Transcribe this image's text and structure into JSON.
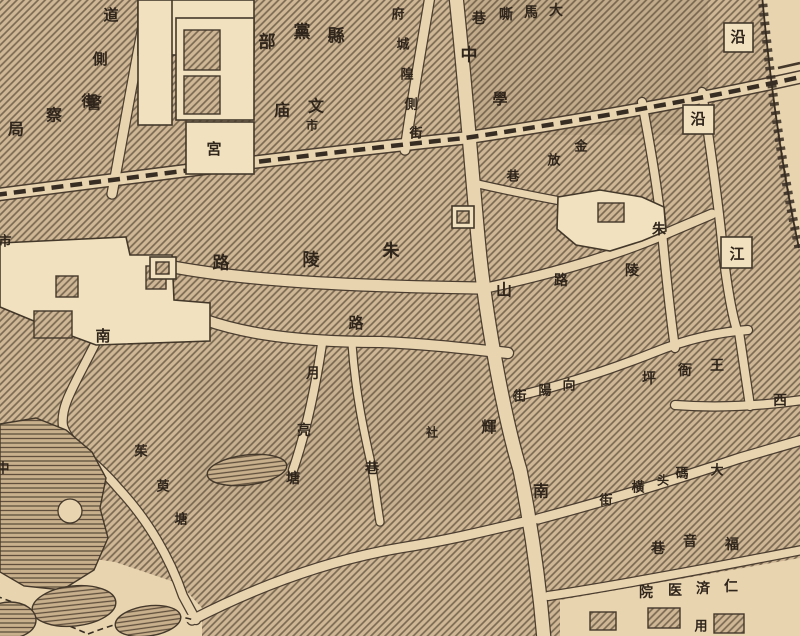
{
  "map": {
    "kind": "historical Chinese city street map (woodcut style)",
    "colors": {
      "paper": "#e9d4b0",
      "building_fill": "#f1e1be",
      "block_base": "#cfb795",
      "ink": "#43382a",
      "label_ink": "#2f251b"
    }
  },
  "labels": [
    {
      "name": "jingchaju",
      "text": "警察局",
      "chars": [
        {
          "c": "局",
          "x": 16,
          "y": 130,
          "s": 16
        },
        {
          "c": "察",
          "x": 54,
          "y": 116,
          "s": 16
        },
        {
          "c": "警",
          "x": 94,
          "y": 104,
          "s": 16
        }
      ]
    },
    {
      "name": "daoce-street",
      "text": "道側街",
      "chars": [
        {
          "c": "道",
          "x": 111,
          "y": 16,
          "s": 15
        },
        {
          "c": "側",
          "x": 100,
          "y": 60,
          "s": 15
        },
        {
          "c": "街",
          "x": 89,
          "y": 102,
          "s": 15
        }
      ]
    },
    {
      "name": "xiandangbu",
      "text": "縣黨部",
      "chars": [
        {
          "c": "部",
          "x": 267,
          "y": 43,
          "s": 17
        },
        {
          "c": "黨",
          "x": 302,
          "y": 33,
          "s": 17
        },
        {
          "c": "縣",
          "x": 336,
          "y": 37,
          "s": 17
        }
      ]
    },
    {
      "name": "wenmiao",
      "text": "文庙",
      "chars": [
        {
          "c": "庙",
          "x": 282,
          "y": 111,
          "s": 16
        },
        {
          "c": "文",
          "x": 316,
          "y": 107,
          "s": 16
        }
      ]
    },
    {
      "name": "shi-small",
      "text": "市",
      "chars": [
        {
          "c": "市",
          "x": 312,
          "y": 126,
          "s": 12
        }
      ]
    },
    {
      "name": "fuchenghuang-street",
      "text": "府城隍側街",
      "chars": [
        {
          "c": "府",
          "x": 398,
          "y": 15,
          "s": 13
        },
        {
          "c": "城",
          "x": 403,
          "y": 45,
          "s": 13
        },
        {
          "c": "隍",
          "x": 407,
          "y": 75,
          "s": 13
        },
        {
          "c": "側",
          "x": 411,
          "y": 105,
          "s": 13
        },
        {
          "c": "街",
          "x": 416,
          "y": 134,
          "s": 13
        }
      ]
    },
    {
      "name": "gong",
      "text": "宮",
      "chars": [
        {
          "c": "宮",
          "x": 214,
          "y": 150,
          "s": 15
        }
      ]
    },
    {
      "name": "damasi-lane",
      "text": "大馬嘶巷",
      "chars": [
        {
          "c": "巷",
          "x": 479,
          "y": 19,
          "s": 14
        },
        {
          "c": "嘶",
          "x": 506,
          "y": 15,
          "s": 14
        },
        {
          "c": "馬",
          "x": 531,
          "y": 13,
          "s": 14
        },
        {
          "c": "大",
          "x": 556,
          "y": 11,
          "s": 14
        }
      ]
    },
    {
      "name": "char-zhong",
      "text": "中",
      "chars": [
        {
          "c": "中",
          "x": 469,
          "y": 56,
          "s": 17
        }
      ]
    },
    {
      "name": "char-xue",
      "text": "學",
      "chars": [
        {
          "c": "學",
          "x": 500,
          "y": 100,
          "s": 15
        }
      ]
    },
    {
      "name": "char-shan",
      "text": "山",
      "chars": [
        {
          "c": "山",
          "x": 504,
          "y": 291,
          "s": 16
        }
      ]
    },
    {
      "name": "char-nan-zhongshan",
      "text": "南",
      "chars": [
        {
          "c": "南",
          "x": 541,
          "y": 492,
          "s": 16
        }
      ]
    },
    {
      "name": "char-yan-1",
      "text": "沿",
      "chars": [
        {
          "c": "沿",
          "x": 738,
          "y": 38,
          "s": 15
        }
      ]
    },
    {
      "name": "char-yan-2",
      "text": "沿",
      "chars": [
        {
          "c": "沿",
          "x": 698,
          "y": 120,
          "s": 15
        }
      ]
    },
    {
      "name": "char-jiang",
      "text": "江",
      "chars": [
        {
          "c": "江",
          "x": 737,
          "y": 255,
          "s": 15
        }
      ]
    },
    {
      "name": "jinfang-lane",
      "text": "金放巷",
      "chars": [
        {
          "c": "金",
          "x": 581,
          "y": 147,
          "s": 13
        },
        {
          "c": "放",
          "x": 554,
          "y": 161,
          "s": 13
        },
        {
          "c": "巷",
          "x": 513,
          "y": 177,
          "s": 13
        }
      ]
    },
    {
      "name": "zhuling-road-west",
      "text": "朱陵路",
      "chars": [
        {
          "c": "路",
          "x": 221,
          "y": 264,
          "s": 17
        },
        {
          "c": "陵",
          "x": 311,
          "y": 261,
          "s": 17
        },
        {
          "c": "朱",
          "x": 391,
          "y": 252,
          "s": 17
        }
      ]
    },
    {
      "name": "char-lu",
      "text": "路",
      "chars": [
        {
          "c": "路",
          "x": 356,
          "y": 324,
          "s": 15
        }
      ]
    },
    {
      "name": "zhuling-road-east",
      "text": "朱陵路",
      "chars": [
        {
          "c": "路",
          "x": 561,
          "y": 281,
          "s": 14
        },
        {
          "c": "陵",
          "x": 632,
          "y": 271,
          "s": 14
        },
        {
          "c": "朱",
          "x": 659,
          "y": 230,
          "s": 14
        }
      ]
    },
    {
      "name": "char-nan-west",
      "text": "南",
      "chars": [
        {
          "c": "南",
          "x": 103,
          "y": 337,
          "s": 15
        }
      ]
    },
    {
      "name": "yueliangtang",
      "text": "月亮塘",
      "chars": [
        {
          "c": "月",
          "x": 313,
          "y": 374,
          "s": 14
        },
        {
          "c": "亮",
          "x": 304,
          "y": 431,
          "s": 14
        },
        {
          "c": "塘",
          "x": 293,
          "y": 479,
          "s": 14
        }
      ]
    },
    {
      "name": "char-xiang",
      "text": "巷",
      "chars": [
        {
          "c": "巷",
          "x": 372,
          "y": 469,
          "s": 14
        }
      ]
    },
    {
      "name": "char-she",
      "text": "社",
      "chars": [
        {
          "c": "社",
          "x": 432,
          "y": 433,
          "s": 12
        }
      ]
    },
    {
      "name": "char-hui",
      "text": "輝",
      "chars": [
        {
          "c": "輝",
          "x": 489,
          "y": 428,
          "s": 15
        }
      ]
    },
    {
      "name": "xiangyang-street",
      "text": "向陽街",
      "chars": [
        {
          "c": "街",
          "x": 520,
          "y": 397,
          "s": 13
        },
        {
          "c": "陽",
          "x": 545,
          "y": 391,
          "s": 13
        },
        {
          "c": "向",
          "x": 569,
          "y": 386,
          "s": 13
        }
      ]
    },
    {
      "name": "wangyaping",
      "text": "王衙坪",
      "chars": [
        {
          "c": "坪",
          "x": 649,
          "y": 379,
          "s": 14
        },
        {
          "c": "衙",
          "x": 685,
          "y": 371,
          "s": 14
        },
        {
          "c": "王",
          "x": 717,
          "y": 366,
          "s": 14
        }
      ]
    },
    {
      "name": "char-xi",
      "text": "西",
      "chars": [
        {
          "c": "西",
          "x": 780,
          "y": 401,
          "s": 14
        }
      ]
    },
    {
      "name": "damatou-heng-street",
      "text": "大碼头橫街",
      "chars": [
        {
          "c": "街",
          "x": 606,
          "y": 501,
          "s": 13
        },
        {
          "c": "橫",
          "x": 638,
          "y": 488,
          "s": 13
        },
        {
          "c": "头",
          "x": 663,
          "y": 481,
          "s": 12
        },
        {
          "c": "碼",
          "x": 682,
          "y": 474,
          "s": 13
        },
        {
          "c": "大",
          "x": 717,
          "y": 471,
          "s": 13
        }
      ]
    },
    {
      "name": "fuyin-lane",
      "text": "福音巷",
      "chars": [
        {
          "c": "巷",
          "x": 658,
          "y": 549,
          "s": 14
        },
        {
          "c": "音",
          "x": 690,
          "y": 542,
          "s": 14
        },
        {
          "c": "福",
          "x": 732,
          "y": 545,
          "s": 14
        }
      ]
    },
    {
      "name": "renji-hospital",
      "text": "仁済医院",
      "chars": [
        {
          "c": "院",
          "x": 646,
          "y": 593,
          "s": 14
        },
        {
          "c": "医",
          "x": 675,
          "y": 591,
          "s": 14
        },
        {
          "c": "済",
          "x": 703,
          "y": 589,
          "s": 14
        },
        {
          "c": "仁",
          "x": 731,
          "y": 587,
          "s": 14
        }
      ]
    },
    {
      "name": "zhuyutang",
      "text": "茱萸塘",
      "chars": [
        {
          "c": "茱",
          "x": 141,
          "y": 452,
          "s": 13
        },
        {
          "c": "萸",
          "x": 163,
          "y": 487,
          "s": 13
        },
        {
          "c": "塘",
          "x": 181,
          "y": 520,
          "s": 13
        }
      ]
    },
    {
      "name": "char-shi-edge",
      "text": "市",
      "chars": [
        {
          "c": "市",
          "x": 5,
          "y": 242,
          "s": 13
        }
      ]
    },
    {
      "name": "char-partial-bottom",
      "text": "用",
      "chars": [
        {
          "c": "用",
          "x": 701,
          "y": 627,
          "s": 13
        }
      ]
    },
    {
      "name": "char-partial-left",
      "text": "中",
      "chars": [
        {
          "c": "中",
          "x": 3,
          "y": 469,
          "s": 13
        }
      ]
    }
  ]
}
